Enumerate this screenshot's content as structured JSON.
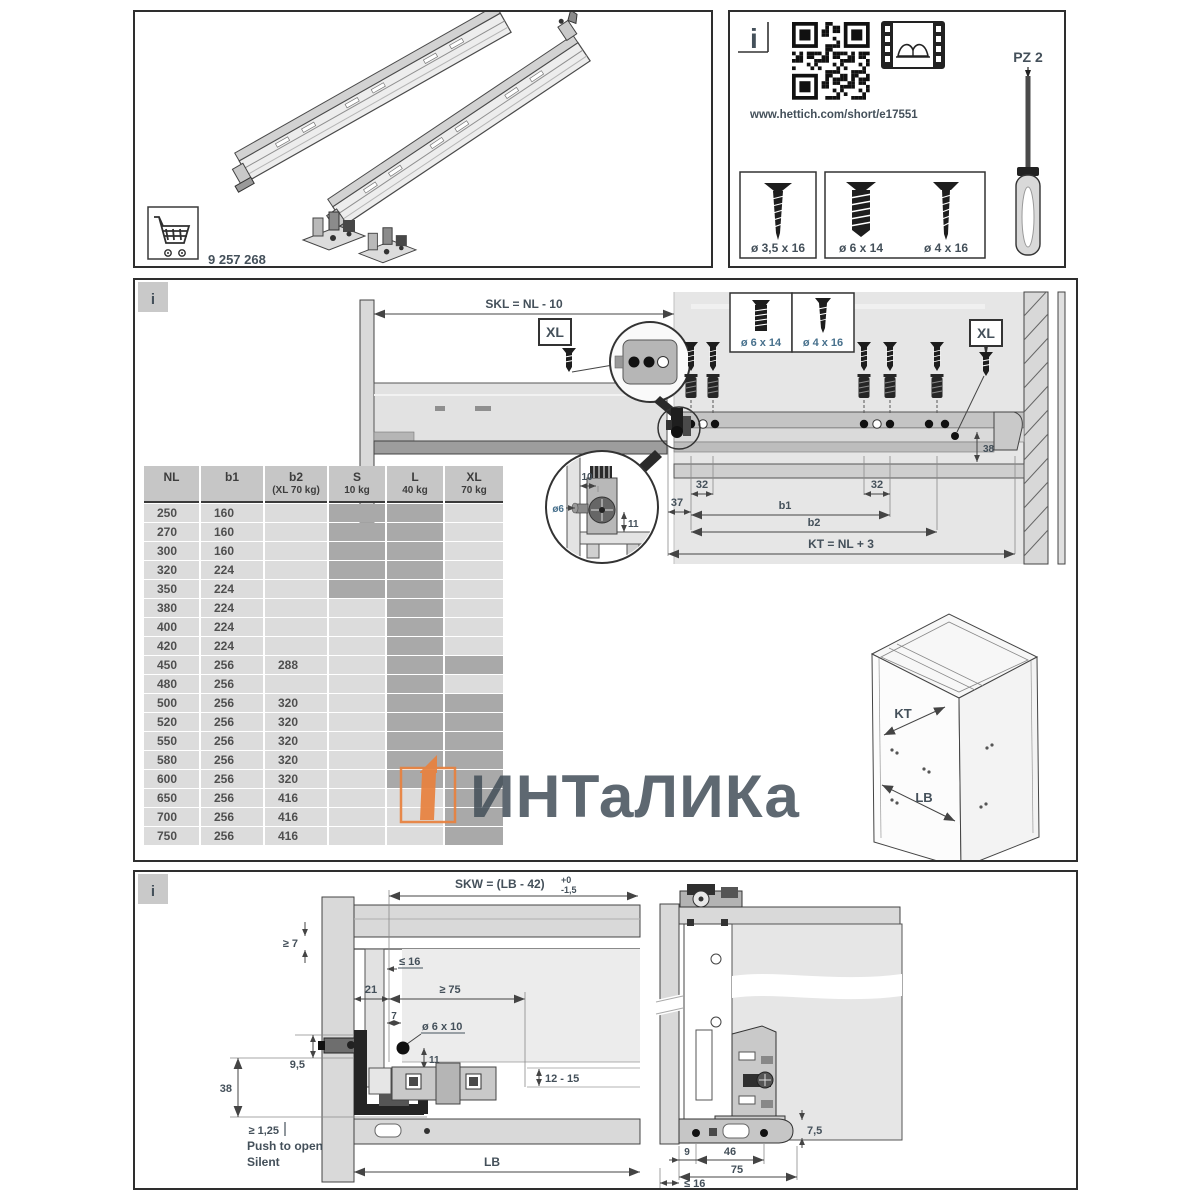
{
  "top_left": {
    "part_number": "9 257 268"
  },
  "top_right": {
    "info": "i",
    "url": "www.hettich.com/short/e17551",
    "screw_small": "ø 3,5 x 16",
    "screw_thick": "ø 6 x 14",
    "screw_thin": "ø 4 x 16",
    "driver": "PZ 2"
  },
  "middle": {
    "info": "i",
    "skl": "SKL = NL - 10",
    "xl_left": "XL",
    "xl_right": "XL",
    "screw6": "ø 6 x 14",
    "screw4": "ø 4 x 16",
    "d38": "38",
    "d32l": "32",
    "d32r": "32",
    "d37": "37",
    "b1": "b1",
    "b2": "b2",
    "kt_formula": "KT = NL + 3",
    "detail_d10": "10",
    "detail_o6": "ø6",
    "detail_d11": "11",
    "cab_kt": "KT",
    "cab_lb": "LB"
  },
  "table": {
    "headers": [
      {
        "t": "NL",
        "s": ""
      },
      {
        "t": "b1",
        "s": ""
      },
      {
        "t": "b2",
        "s": "(XL 70 kg)"
      },
      {
        "t": "S",
        "s": "10 kg"
      },
      {
        "t": "L",
        "s": "40 kg"
      },
      {
        "t": "XL",
        "s": "70 kg"
      }
    ],
    "rows": [
      {
        "nl": "250",
        "b1": "160",
        "b2": "",
        "s": true,
        "l": true,
        "xl": false
      },
      {
        "nl": "270",
        "b1": "160",
        "b2": "",
        "s": true,
        "l": true,
        "xl": false
      },
      {
        "nl": "300",
        "b1": "160",
        "b2": "",
        "s": true,
        "l": true,
        "xl": false
      },
      {
        "nl": "320",
        "b1": "224",
        "b2": "",
        "s": true,
        "l": true,
        "xl": false
      },
      {
        "nl": "350",
        "b1": "224",
        "b2": "",
        "s": true,
        "l": true,
        "xl": false
      },
      {
        "nl": "380",
        "b1": "224",
        "b2": "",
        "s": false,
        "l": true,
        "xl": false
      },
      {
        "nl": "400",
        "b1": "224",
        "b2": "",
        "s": false,
        "l": true,
        "xl": false
      },
      {
        "nl": "420",
        "b1": "224",
        "b2": "",
        "s": false,
        "l": true,
        "xl": false
      },
      {
        "nl": "450",
        "b1": "256",
        "b2": "288",
        "s": false,
        "l": true,
        "xl": true
      },
      {
        "nl": "480",
        "b1": "256",
        "b2": "",
        "s": false,
        "l": true,
        "xl": false
      },
      {
        "nl": "500",
        "b1": "256",
        "b2": "320",
        "s": false,
        "l": true,
        "xl": true
      },
      {
        "nl": "520",
        "b1": "256",
        "b2": "320",
        "s": false,
        "l": true,
        "xl": true
      },
      {
        "nl": "550",
        "b1": "256",
        "b2": "320",
        "s": false,
        "l": true,
        "xl": true
      },
      {
        "nl": "580",
        "b1": "256",
        "b2": "320",
        "s": false,
        "l": true,
        "xl": true
      },
      {
        "nl": "600",
        "b1": "256",
        "b2": "320",
        "s": false,
        "l": true,
        "xl": true
      },
      {
        "nl": "650",
        "b1": "256",
        "b2": "416",
        "s": false,
        "l": false,
        "xl": true
      },
      {
        "nl": "700",
        "b1": "256",
        "b2": "416",
        "s": false,
        "l": false,
        "xl": true
      },
      {
        "nl": "750",
        "b1": "256",
        "b2": "416",
        "s": false,
        "l": false,
        "xl": true
      }
    ]
  },
  "bottom": {
    "info": "i",
    "skw": "SKW = (LB - 42)",
    "skw_sup": "+0",
    "skw_sub": "-1,5",
    "ge7": "≥ 7",
    "le16": "≤ 16",
    "d21": "21",
    "ge75": "≥ 75",
    "d7": "7",
    "o6x10": "ø 6 x 10",
    "d11": "11",
    "d95": "9,5",
    "d38": "38",
    "ge125": "≥ 1,25",
    "push": "Push to open",
    "silent": "Silent",
    "d1215": "12 - 15",
    "lb": "LB",
    "d75r": "7,5",
    "d9": "9",
    "d46": "46",
    "d75": "75",
    "le16r": "≤ 16"
  },
  "watermark": {
    "text": "ИНТаЛИКа",
    "orange": "#e8823f",
    "gray": "#9e9e9e"
  },
  "colors": {
    "panel_border": "#2e2e2e",
    "dim_text": "#44505a",
    "blue_label": "#47708c",
    "table_header": "#c6c6c6",
    "table_cell": "#dcdcdc",
    "table_shaded": "#a9a9a9"
  }
}
